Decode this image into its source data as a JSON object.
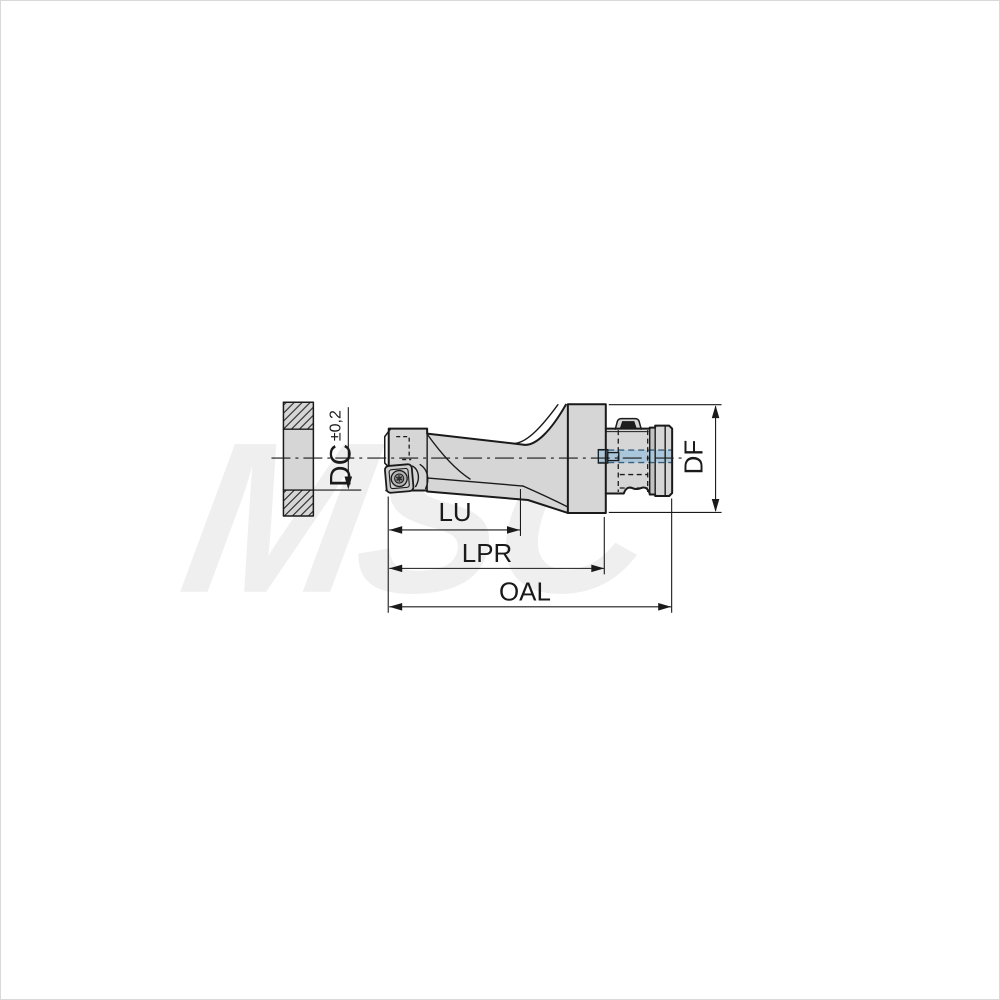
{
  "watermark": {
    "text": "MSC"
  },
  "dimensions": {
    "dc_label": "DC",
    "dc_tolerance": "±0,2",
    "lu_label": "LU",
    "lpr_label": "LPR",
    "oal_label": "OAL",
    "df_label": "DF"
  },
  "colors": {
    "line": "#1a1a1a",
    "body_fill": "#d6d6d6",
    "band_fill": "#c2c2c2",
    "insert_fill": "#cdcdcd",
    "screw_fill": "#b5b5b5",
    "dark_detail": "#1e1e1e",
    "coolant_blue": "#a9c6da",
    "coolant_dash": "#3c617c",
    "watermark_gray": "#efefef",
    "background": "#ffffff",
    "border_gray": "#d9d9d9"
  }
}
